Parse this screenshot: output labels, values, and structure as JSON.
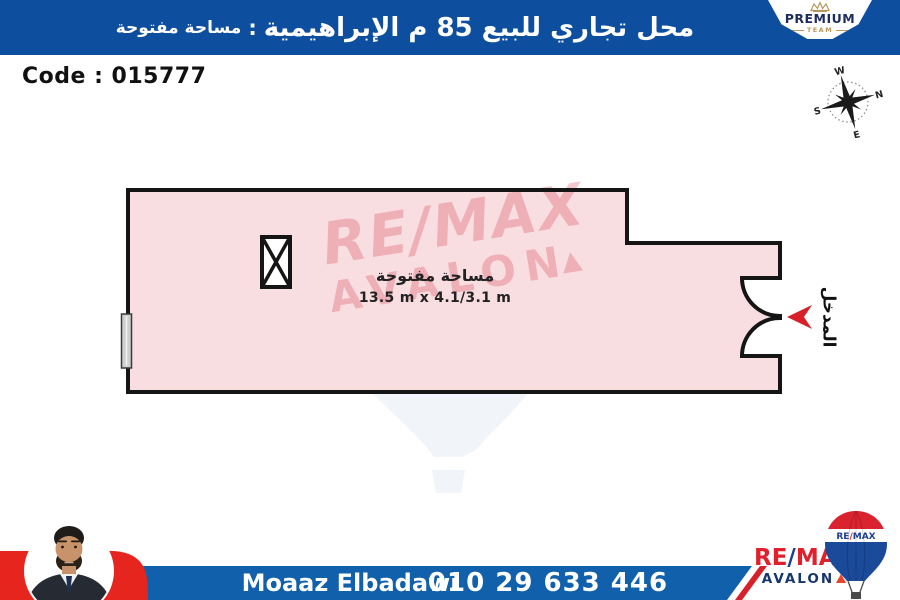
{
  "header": {
    "title_main": "محل تجاري للبيع 85 م الإبراهيمية",
    "title_sep": ":",
    "title_sub": "مساحة مفتوحة",
    "premium": {
      "line1": "PREMIUM",
      "line2": "TEAM"
    }
  },
  "code_label": "Code : 015777",
  "compass": {
    "n": "N",
    "e": "E",
    "s": "S",
    "w": "W"
  },
  "floorplan": {
    "room_label": "مساحة مفتوحة",
    "room_dimensions": "13.5 m x 4.1/3.1 m",
    "entrance_label": "المدخل"
  },
  "watermark": {
    "line1": "RE/MAX",
    "line2": "AVALON"
  },
  "footer": {
    "agent_name": "Moaaz Elbadawi",
    "phone": "010 29 633 446",
    "brand": {
      "re": "RE",
      "slash": "/",
      "max": "MAX",
      "sub": "AVALON",
      "balloon_re": "RE",
      "balloon_slash": "/",
      "balloon_max": "MAX"
    }
  },
  "colors": {
    "header_blue": "#0d4f9e",
    "footer_blue": "#1160ab",
    "brand_red": "#e0202c",
    "brand_navy": "#17366b",
    "slash_blue": "#1e3d8f",
    "accent_red": "#d6212b",
    "photo_band_red": "#e6251f",
    "plan_fill": "#f8dde1",
    "wall_black": "#151515",
    "window_gray": "#cfcfcf",
    "premium_gold": "#b9985d",
    "premium_navy": "#1d2d5c",
    "watermark_pink": "#d94a57",
    "watermark_balloon": "#e3e9f2"
  }
}
